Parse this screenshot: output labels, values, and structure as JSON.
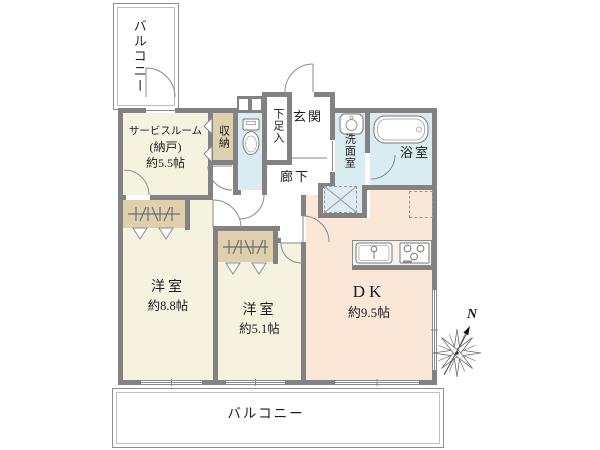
{
  "plan": {
    "balcony_top": {
      "label": "バルコニー"
    },
    "balcony_bottom": {
      "label": "バルコニー"
    },
    "service_room": {
      "name": "サービスルーム",
      "subname": "(納戸)",
      "size": "約5.5帖"
    },
    "storage": {
      "name": "収納"
    },
    "shoe_cabinet": {
      "name": "下足入"
    },
    "entrance": {
      "name": "玄関"
    },
    "hallway": {
      "name": "廊下"
    },
    "washroom": {
      "name": "洗面室"
    },
    "bathroom": {
      "name": "浴室"
    },
    "bedroom_1": {
      "name": "洋室",
      "size": "約8.8帖"
    },
    "bedroom_2": {
      "name": "洋室",
      "size": "約5.1帖"
    },
    "dining_kitchen": {
      "name": "DK",
      "size": "約9.5帖"
    },
    "compass": {
      "label": "N"
    },
    "icons": {
      "toilet": "toilet-icon",
      "bathtub": "bathtub-icon",
      "washbasin": "washbasin-icon",
      "kitchen_sink": "kitchen-sink-icon",
      "stove": "stove-icon",
      "washer_pan": "washing-machine-pan-icon",
      "refrigerator": "refrigerator-outline-icon",
      "closet_hanger": "closet-hanger-icon",
      "compass": "compass-north-icon"
    },
    "colors": {
      "wall": "#828282",
      "room_floor": "#f5f3e0",
      "dk_floor": "#fae7d8",
      "wet_area": "#d9ecf2",
      "closet": "#ddd1ad",
      "line": "#8a8a8a"
    }
  }
}
